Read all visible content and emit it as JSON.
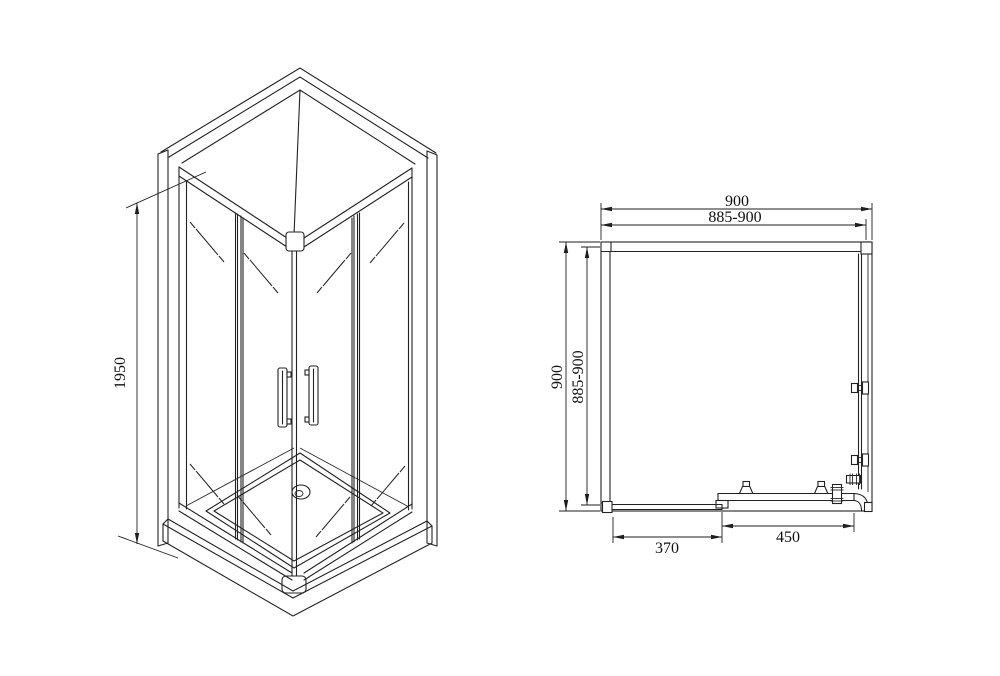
{
  "drawing": {
    "iso": {
      "height": "1950"
    },
    "plan": {
      "width_outer": "900",
      "width_inner": "885-900",
      "depth_outer": "900",
      "depth_inner": "885-900",
      "door_small": "370",
      "door_large": "450"
    }
  }
}
